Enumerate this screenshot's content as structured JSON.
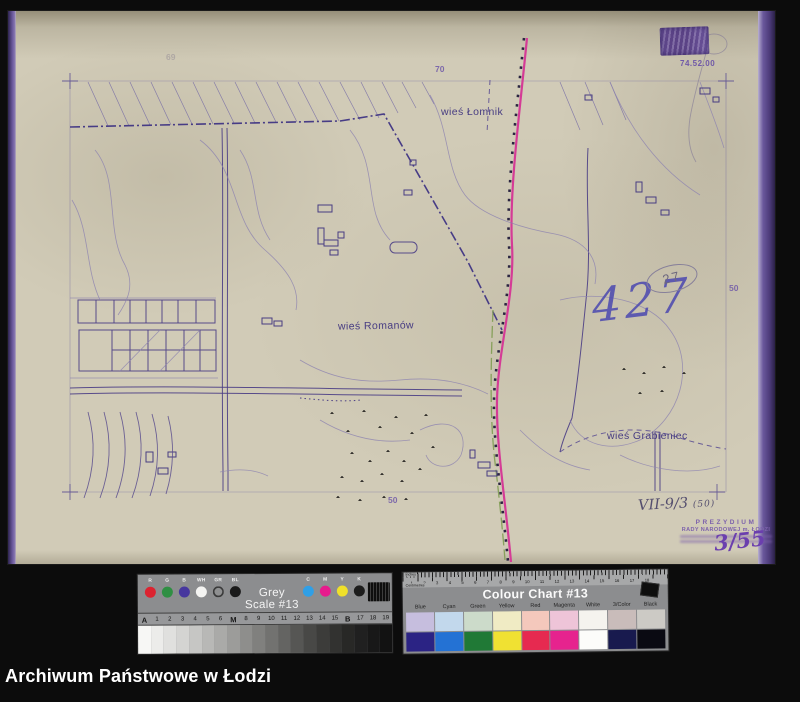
{
  "footer": {
    "title": "Archiwum Państwowe w Łodzi"
  },
  "map": {
    "labels": {
      "lomnik": "wieś Łomnik",
      "romanow": "wieś Romanów",
      "grabieniec": "wieś Grabieniec"
    },
    "annotations": {
      "inventory_number": "427",
      "circled_number": "27",
      "top_right_number": "74.52.00",
      "sheet_number_top": "70",
      "sheet_number_top_left": "69",
      "sheet_number_right": "50",
      "sheet_number_bottom": "50",
      "reference_code": "VII-9/3",
      "reference_code_suffix": "(50)",
      "stamp_fraction": "3/55"
    },
    "stamp": {
      "line1": "PREZYDIUM",
      "line2": "RADY NARODOWEJ m. ŁODZI"
    }
  },
  "grey_scale_card": {
    "title": "Grey Scale #13",
    "dot_labels_left": [
      "R",
      "G",
      "B",
      "WH",
      "GR",
      "BL"
    ],
    "dot_colors_left": [
      "#dc2330",
      "#2f8f43",
      "#47379e",
      "#f4f4f2",
      "#8f9091",
      "#1a1a1a"
    ],
    "dot_labels_right": [
      "C",
      "M",
      "Y",
      "K"
    ],
    "dot_colors_right": [
      "#2f9fe6",
      "#e61b8d",
      "#efe02a",
      "#1c1c1c"
    ],
    "scale_labels": [
      "A",
      "1",
      "2",
      "3",
      "4",
      "5",
      "6",
      "M",
      "8",
      "9",
      "10",
      "11",
      "12",
      "13",
      "14",
      "15",
      "B",
      "17",
      "18",
      "19"
    ],
    "scale_steps": [
      "#f7f7f5",
      "#ececea",
      "#e0e0de",
      "#d4d4d2",
      "#c6c6c4",
      "#b8b8b6",
      "#aaaaa8",
      "#9c9c9a",
      "#8e8e8c",
      "#80807e",
      "#727270",
      "#646462",
      "#565654",
      "#484846",
      "#3c3c3a",
      "#323230",
      "#282826",
      "#202020",
      "#181818",
      "#121212"
    ]
  },
  "colour_chart_card": {
    "title": "Colour Chart #13",
    "ruler_label_top": "Inches",
    "ruler_label_bottom": "Centimetres",
    "ruler_numbers": "1 2 3 4 5 6 7 8 9 10 11 12 13 14 15 16 17 18",
    "columns": [
      "Blue",
      "Cyan",
      "Green",
      "Yellow",
      "Red",
      "Magenta",
      "White",
      "3/Color",
      "Black"
    ],
    "row_pastel": [
      "#c6bede",
      "#c2d8ec",
      "#ccdbca",
      "#f0ebc4",
      "#f4c8bc",
      "#eec4d8",
      "#f5f3ee",
      "#c9bcba",
      "#cccac5"
    ],
    "row_saturated": [
      "#2b2384",
      "#2472d4",
      "#207936",
      "#f0e132",
      "#e62a50",
      "#e6238e",
      "#fcfcfa",
      "#181a4e",
      "#0a0a12"
    ]
  }
}
